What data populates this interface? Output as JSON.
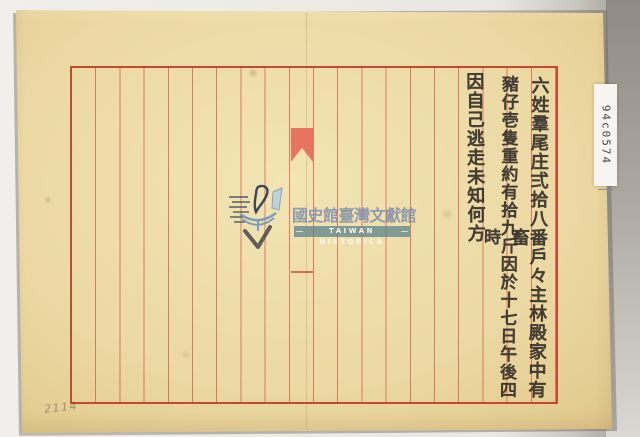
{
  "scan": {
    "archive_label": "94c0574",
    "pencil_note": "2114"
  },
  "letter": {
    "columns": [
      "六姓羣尾庄弍拾八番戶々主林殿家中有畜",
      "豬仔壱隻重約有拾九斤因於十七日午後四時",
      "因自己逃走未知何方"
    ]
  },
  "watermark": {
    "org_zh": "國史館臺灣文獻館",
    "org_en": "TAIWAN HISTORICA"
  },
  "colors": {
    "paper": "#ecd9a4",
    "rule_red": "#cd5842",
    "frame_red": "#c24a33",
    "fishtail_red": "#e8735e",
    "ink": "#35302a",
    "watermark_blue": "#7387aa",
    "watermark_teal": "#5c828c",
    "background_gray": "#98948d"
  }
}
